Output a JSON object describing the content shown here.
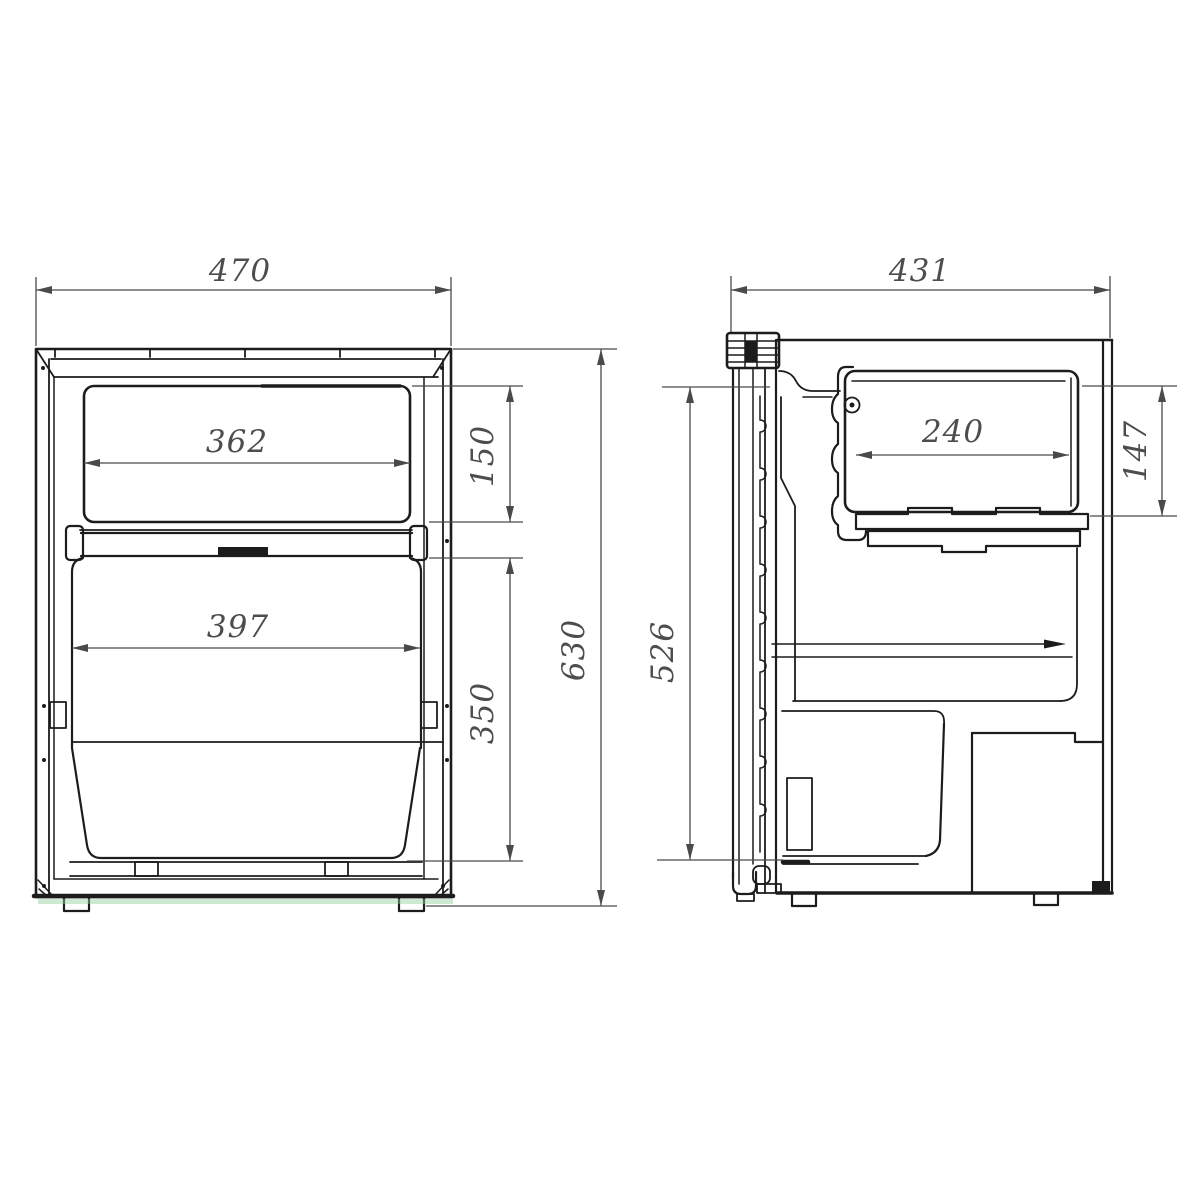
{
  "title": "refrigerator-dimension-drawing",
  "colors": {
    "background": "#ffffff",
    "line": "#1c1c1c",
    "dim": "#4a4a4a",
    "dimtext": "#4d4d4d",
    "tint": "#8fce9e"
  },
  "views": {
    "front": {
      "name": "front-view",
      "dimensions": [
        {
          "id": "overall-width",
          "value": "470",
          "orientation": "horizontal"
        },
        {
          "id": "upper-inner-width",
          "value": "362",
          "orientation": "horizontal"
        },
        {
          "id": "upper-section-height",
          "value": "150",
          "orientation": "vertical"
        },
        {
          "id": "lower-inner-width",
          "value": "397",
          "orientation": "horizontal"
        },
        {
          "id": "lower-section-height",
          "value": "350",
          "orientation": "vertical"
        },
        {
          "id": "overall-height",
          "value": "630",
          "orientation": "vertical"
        }
      ]
    },
    "side": {
      "name": "side-view",
      "dimensions": [
        {
          "id": "overall-depth",
          "value": "431",
          "orientation": "horizontal"
        },
        {
          "id": "freezer-inner-depth",
          "value": "240",
          "orientation": "horizontal"
        },
        {
          "id": "freezer-section-height",
          "value": "147",
          "orientation": "vertical"
        },
        {
          "id": "interior-height",
          "value": "526",
          "orientation": "vertical"
        }
      ]
    }
  }
}
